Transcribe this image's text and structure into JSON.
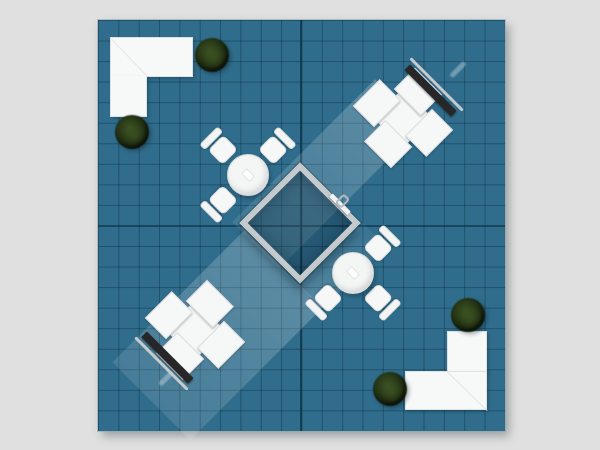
{
  "scene": {
    "title": "Trade show booth floor plan — top view",
    "floor": {
      "tiles_x": 20,
      "tiles_y": 20,
      "shape": "square",
      "has_center_gridlines": true
    },
    "objects": [
      {
        "id": "counter-top-left",
        "type": "l-shaped-counter",
        "position": "top-left",
        "detail": "white L counter with diagonal corner seam"
      },
      {
        "id": "counter-bottom-right",
        "type": "l-shaped-counter",
        "position": "bottom-right",
        "detail": "white L counter with diagonal corner seam"
      },
      {
        "id": "plant-1",
        "type": "potted-plant",
        "position": "right end of top-left counter"
      },
      {
        "id": "plant-2",
        "type": "potted-plant",
        "position": "below top-left counter"
      },
      {
        "id": "plant-3",
        "type": "potted-plant",
        "position": "above bottom-right counter"
      },
      {
        "id": "plant-4",
        "type": "potted-plant",
        "position": "left of bottom-right counter"
      },
      {
        "id": "meeting-room",
        "type": "enclosed-meeting-room",
        "position": "center",
        "rotation_deg": 45,
        "features": [
          "gray walls",
          "door leaf",
          "door handle"
        ]
      },
      {
        "id": "table-upper",
        "type": "round-cafe-table",
        "chair_count": 3,
        "chair_angles_deg": [
          -45,
          45,
          -135
        ],
        "position": "upper-left of center room"
      },
      {
        "id": "table-lower",
        "type": "round-cafe-table",
        "chair_count": 3,
        "chair_angles_deg": [
          45,
          135,
          -135
        ],
        "position": "lower-right of center room"
      },
      {
        "id": "workstation-top-right",
        "type": "pinwheel-cross-workstation",
        "rotation_deg": 45,
        "features": [
          "media screen wall on NE side",
          "outer rail"
        ]
      },
      {
        "id": "workstation-bottom-left",
        "type": "pinwheel-cross-workstation",
        "rotation_deg": 45,
        "features": [
          "media screen wall on SW side",
          "outer rail"
        ]
      },
      {
        "id": "beam-upper",
        "type": "light-projection-band",
        "from": "top-right screen",
        "to": "center room"
      },
      {
        "id": "beam-lower",
        "type": "light-projection-band",
        "from": "bottom-left screen",
        "to": "center room"
      },
      {
        "id": "glint-top-right",
        "type": "light-glint",
        "position": "beyond top-right screen"
      },
      {
        "id": "glint-bottom-left",
        "type": "light-glint",
        "position": "beyond bottom-left screen"
      }
    ],
    "palette": {
      "bg": "#e0e0e0",
      "floor": "#306d8c",
      "grid_line": "rgba(8,44,64,0.42)",
      "grid_major": "rgba(6,40,58,0.65)",
      "wall": "#c5cacc",
      "room_fill": "rgba(8,32,48,0.25)",
      "furniture_white": "#f6f7f7",
      "furniture_edge": "#dcdedf",
      "screen": "#27272a",
      "rail": "#c6cacb",
      "plant_dark": "#111a08",
      "plant_light": "#3a5122",
      "beam_white": "rgba(255,255,255,0.2)"
    }
  }
}
